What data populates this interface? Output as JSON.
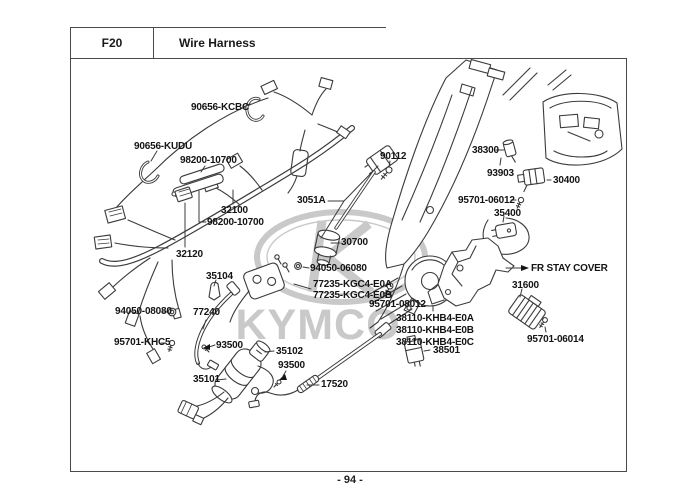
{
  "header": {
    "code": "F20",
    "title": "Wire Harness"
  },
  "footer": {
    "page_number": "- 94 -"
  },
  "watermark": {
    "brand": "KYMCO",
    "color": "#c7c7c7"
  },
  "colors": {
    "line": "#3b3b3b",
    "label_text": "#141414",
    "frame_border": "#4a4a4a",
    "background": "#ffffff"
  },
  "callouts": [
    {
      "text": "90656-KCBC"
    },
    {
      "text": "90656-KUDU"
    },
    {
      "text": "98200-10700"
    },
    {
      "text": "32100"
    },
    {
      "text": "98200-10700"
    },
    {
      "text": "32120"
    },
    {
      "text": "35104"
    },
    {
      "text": "90112"
    },
    {
      "text": "3051A"
    },
    {
      "text": "30700"
    },
    {
      "text": "94050-06080"
    },
    {
      "text": "77235-KGC4-E0A"
    },
    {
      "text": "77235-KGC4-E0B"
    },
    {
      "text": "95701-08012"
    },
    {
      "text": "38110-KHB4-E0A"
    },
    {
      "text": "38110-KHB4-E0B"
    },
    {
      "text": "38110-KHB4-E0C"
    },
    {
      "text": "38501"
    },
    {
      "text": "38300"
    },
    {
      "text": "93903"
    },
    {
      "text": "30400"
    },
    {
      "text": "95701-06012"
    },
    {
      "text": "35400"
    },
    {
      "text": "FR STAY COVER"
    },
    {
      "text": "31600"
    },
    {
      "text": "95701-06014"
    },
    {
      "text": "94050-08080"
    },
    {
      "text": "77240"
    },
    {
      "text": "95701-KHC5"
    },
    {
      "text": "93500"
    },
    {
      "text": "35102"
    },
    {
      "text": "93500"
    },
    {
      "text": "35101"
    },
    {
      "text": "17520"
    }
  ]
}
